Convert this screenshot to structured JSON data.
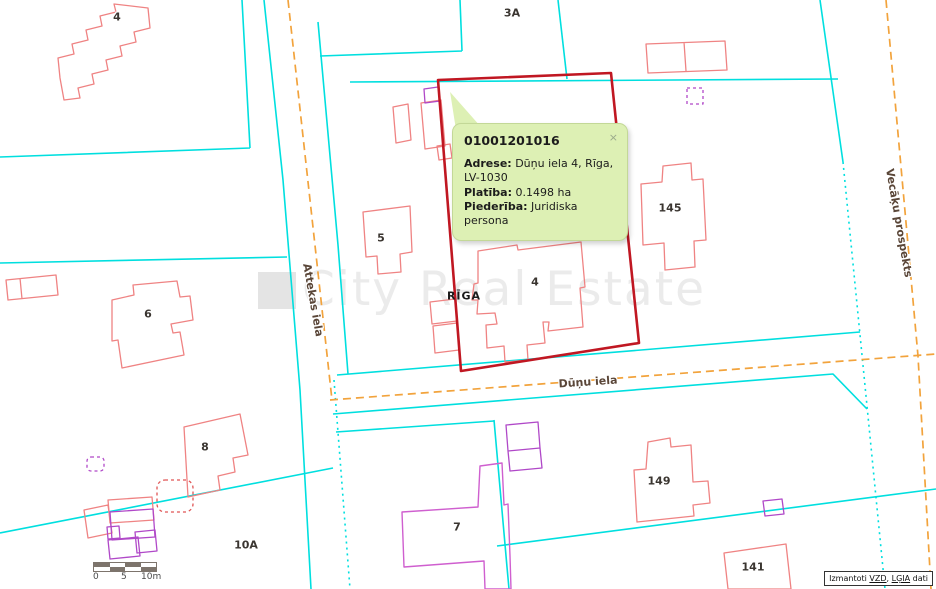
{
  "popup": {
    "title": "01001201016",
    "close_label": "×",
    "fields": [
      {
        "label": "Adrese:",
        "value": "Dūņu iela 4, Rīga, LV-1030"
      },
      {
        "label": "Platība:",
        "value": "0.1498 ha"
      },
      {
        "label": "Piederība:",
        "value": "Juridiska persona"
      }
    ]
  },
  "map": {
    "city_label": "RĪGA",
    "watermark": "City Real Estate",
    "building_labels": [
      {
        "text": "4"
      },
      {
        "text": "3A"
      },
      {
        "text": "145"
      },
      {
        "text": "5"
      },
      {
        "text": "6"
      },
      {
        "text": "4"
      },
      {
        "text": "8"
      },
      {
        "text": "10A"
      },
      {
        "text": "7"
      },
      {
        "text": "149"
      },
      {
        "text": "141"
      }
    ],
    "street_labels": [
      {
        "text": "Attekas iela"
      },
      {
        "text": "Dūņu iela"
      },
      {
        "text": "Vecāķu prospekts"
      }
    ],
    "colors": {
      "parcel_boundary": "#00dfdf",
      "street_centerline": "#f2a33c",
      "selected_parcel": "#c01722",
      "building_red": "#ef8383",
      "building_purple": "#b048c8",
      "building_pink": "#cf5fcf",
      "popup_bg": "#ddf0b4"
    }
  },
  "scalebar": {
    "ticks": [
      "0",
      "5",
      "10m"
    ]
  },
  "attribution": {
    "prefix": "Izmantoti ",
    "link_vzd": "VZD",
    "separator": ", ",
    "link_lgia": "LĢIA",
    "suffix": " dati"
  }
}
